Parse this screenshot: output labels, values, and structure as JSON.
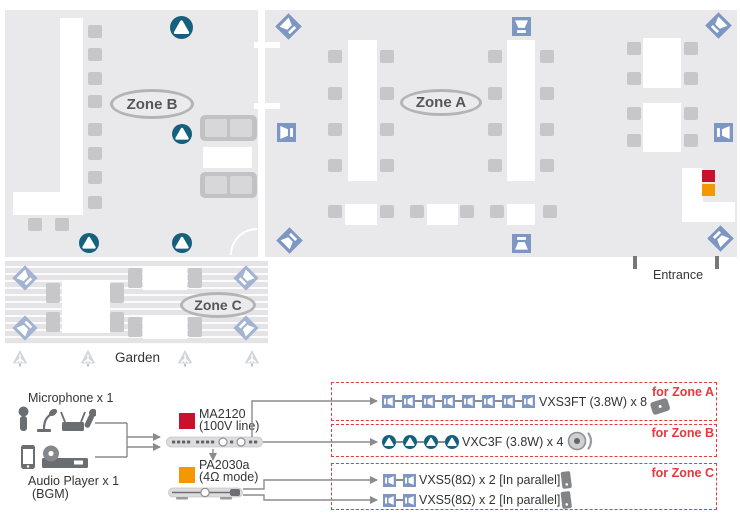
{
  "floor_plan": {
    "zone_a_label": "Zone A",
    "zone_b_label": "Zone B",
    "zone_c_label": "Zone C",
    "garden_label": "Garden",
    "entrance_label": "Entrance"
  },
  "system_diagram": {
    "microphone_label": "Microphone x 1",
    "audio_player_label": "Audio Player x 1",
    "audio_player_sublabel": "(BGM)",
    "ma2120": {
      "name": "MA2120",
      "mode": "(100V line)"
    },
    "pa2030a": {
      "name": "PA2030a",
      "mode": "(4Ω mode)"
    },
    "rows": [
      {
        "zone_tag": "for Zone A",
        "speakers_label": "VXS3FT (3.8W) x 8",
        "speaker_model": "VXS3FT",
        "speaker_count": 8
      },
      {
        "zone_tag": "for Zone B",
        "speakers_label": "VXC3F (3.8W) x 4",
        "speaker_model": "VXC3F",
        "speaker_count": 4
      },
      {
        "zone_tag": "for Zone C",
        "speaker_model": "VXS5",
        "lines": [
          {
            "speakers_label": "VXS5(8Ω) x 2 [In parallel]",
            "speaker_count": 2
          },
          {
            "speakers_label": "VXS5(8Ω) x 2 [In parallel]",
            "speaker_count": 2
          }
        ]
      }
    ]
  },
  "icons": {
    "wall_speaker_icon": "blue square surface-mount speaker",
    "corner_speaker_icon": "blue diamond corner-mount speaker",
    "ceiling_speaker_icon": "teal circle ceiling speaker",
    "garden_tree_icon": "gray plant",
    "microphone_icons": "handheld mic, gooseneck mic, wireless mic set",
    "audio_player_icons": "smartphone, cd player",
    "amplifier_images": "MA2120 rack strip, PA2030a rack strip"
  },
  "colors": {
    "room_bg": "#e9e9eb",
    "stripe_bg": "#e4e4e6",
    "furniture_gray": "#c7c7ca",
    "table_white": "#ffffff",
    "speaker_blue": "#7e96c2",
    "speaker_blue_light": "#a3b4d2",
    "ceiling_teal": "#15607f",
    "ma2120_red": "#c9102c",
    "pa2030a_orange": "#f39800",
    "dashed_red": "#e8373d",
    "line_gray": "#8b8b8d"
  }
}
